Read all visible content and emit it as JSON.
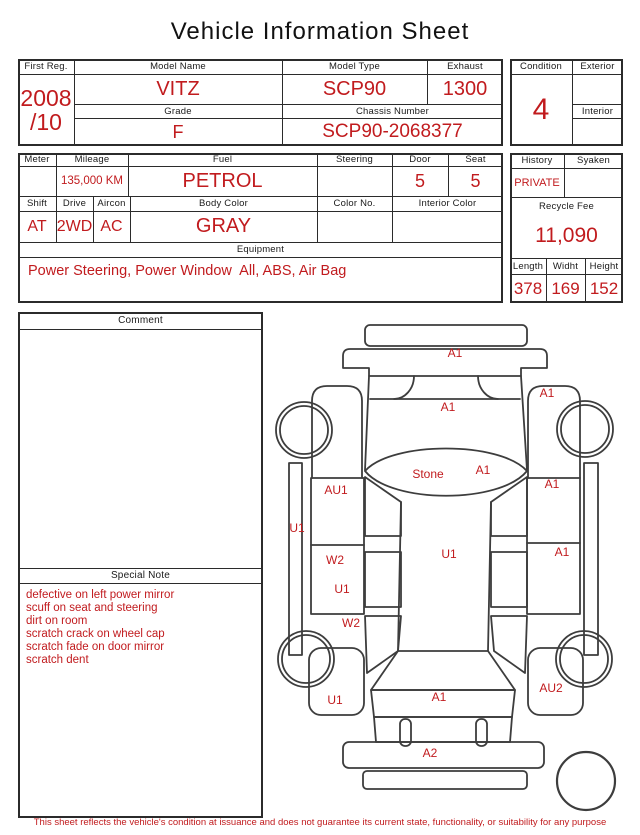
{
  "colors": {
    "accent_red": "#c11b1e",
    "table_line": "#2b2b2b",
    "diagram_line": "#3d3d3d"
  },
  "title": "Vehicle Information Sheet",
  "registration": {
    "first_reg": {
      "label": "First Reg.",
      "value_line1": "2008",
      "value_line2": "/10"
    },
    "model_name": {
      "label": "Model Name",
      "value": "VITZ"
    },
    "model_type": {
      "label": "Model Type",
      "value": "SCP90"
    },
    "exhaust": {
      "label": "Exhaust",
      "value": "1300"
    },
    "grade": {
      "label": "Grade",
      "value": "F"
    },
    "chassis_number": {
      "label": "Chassis Number",
      "value": "SCP90-2068377"
    },
    "condition": {
      "label": "Condition",
      "value": "4"
    },
    "exterior": {
      "label": "Exterior",
      "value": ""
    },
    "interior": {
      "label": "Interior",
      "value": ""
    }
  },
  "details": {
    "meter": {
      "label": "Meter",
      "value": ""
    },
    "mileage": {
      "label": "Mileage",
      "value": "135,000 KM"
    },
    "fuel": {
      "label": "Fuel",
      "value": "PETROL"
    },
    "steering": {
      "label": "Steering",
      "value": ""
    },
    "door": {
      "label": "Door",
      "value": "5"
    },
    "seat": {
      "label": "Seat",
      "value": "5"
    },
    "shift": {
      "label": "Shift",
      "value": "AT"
    },
    "drive": {
      "label": "Drive",
      "value": "2WD"
    },
    "aircon": {
      "label": "Aircon",
      "value": "AC"
    },
    "body_color": {
      "label": "Body Color",
      "value": "GRAY"
    },
    "color_no": {
      "label": "Color No.",
      "value": ""
    },
    "interior_color": {
      "label": "Interior Color",
      "value": ""
    },
    "equipment": {
      "label": "Equipment",
      "value": "Power Steering, Power Window  All, ABS, Air Bag"
    },
    "history": {
      "label": "History",
      "value": "PRIVATE"
    },
    "syaken": {
      "label": "Syaken",
      "value": ""
    },
    "recycle_fee": {
      "label": "Recycle Fee",
      "value": "11,090"
    },
    "length": {
      "label": "Length",
      "value": "378"
    },
    "width": {
      "label": "Widht",
      "value": "169"
    },
    "height": {
      "label": "Height",
      "value": "152"
    }
  },
  "comment": {
    "label": "Comment",
    "value": ""
  },
  "special_note": {
    "label": "Special Note",
    "lines": [
      "defective on left power mirror",
      "scuff on seat and steering",
      "dirt on room",
      "scratch crack on wheel cap",
      "scratch fade on door mirror",
      "scratch dent"
    ]
  },
  "diagram": {
    "labels": [
      {
        "text": "A1",
        "x": 455,
        "y": 353
      },
      {
        "text": "A1",
        "x": 448,
        "y": 407
      },
      {
        "text": "A1",
        "x": 547,
        "y": 393
      },
      {
        "text": "Stone",
        "x": 428,
        "y": 474
      },
      {
        "text": "A1",
        "x": 483,
        "y": 470
      },
      {
        "text": "AU1",
        "x": 336,
        "y": 490
      },
      {
        "text": "A1",
        "x": 552,
        "y": 484
      },
      {
        "text": "U1",
        "x": 297,
        "y": 528
      },
      {
        "text": "W2",
        "x": 335,
        "y": 560
      },
      {
        "text": "U1",
        "x": 449,
        "y": 554
      },
      {
        "text": "A1",
        "x": 562,
        "y": 552
      },
      {
        "text": "U1",
        "x": 342,
        "y": 589
      },
      {
        "text": "W2",
        "x": 351,
        "y": 623
      },
      {
        "text": "U1",
        "x": 335,
        "y": 700
      },
      {
        "text": "A1",
        "x": 439,
        "y": 697
      },
      {
        "text": "AU2",
        "x": 551,
        "y": 688
      },
      {
        "text": "A2",
        "x": 430,
        "y": 753
      }
    ]
  },
  "footer": "This sheet reflects the vehicle's condition at issuance and does not guarantee its current state, functionality, or suitability for any purpose"
}
